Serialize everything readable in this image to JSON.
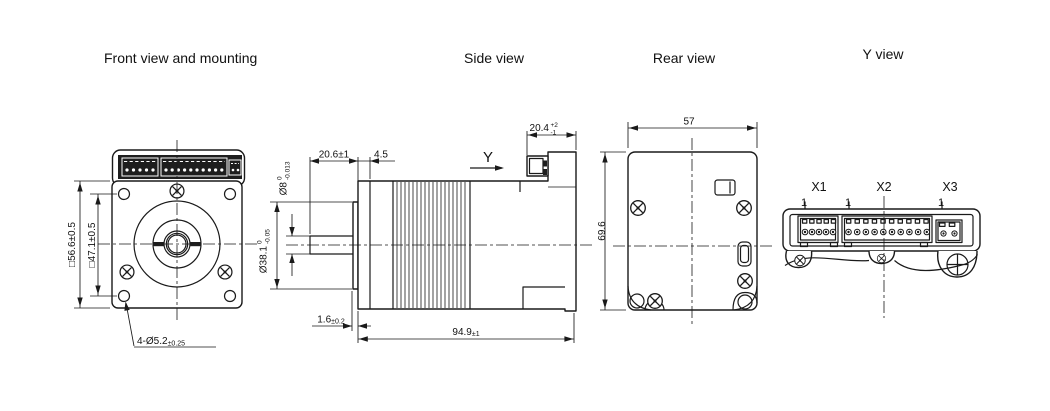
{
  "colors": {
    "line": "#1a1a1a",
    "background": "#ffffff",
    "connector_panel": "#1e1e1e"
  },
  "views": {
    "front": {
      "title": "Front view and mounting",
      "dims": {
        "outer_square": "□56.6±0.5",
        "bolt_square": "□47.1±0.5",
        "mount_holes": "4-Ø5.2",
        "mount_holes_tol": "±0.25"
      }
    },
    "side": {
      "title": "Side view",
      "view_label": "Y",
      "dims": {
        "shaft_length": "20.6±1",
        "front_plate": "4.5",
        "shaft_dia": "Ø8",
        "shaft_dia_upper": "0",
        "shaft_dia_lower": "-0.013",
        "pilot_dia": "Ø38.1",
        "pilot_dia_upper": "0",
        "pilot_dia_lower": "-0.05",
        "pilot_height": "1.6",
        "pilot_height_tol": "±0.2",
        "body_length": "94.9",
        "body_length_tol": "±1",
        "rear_housing": "20.4",
        "rear_housing_upper": "+2",
        "rear_housing_lower": "-1"
      }
    },
    "rear": {
      "title": "Rear view",
      "dims": {
        "width": "57",
        "height": "69.6"
      }
    },
    "yview": {
      "title": "Y view",
      "connectors": [
        {
          "label": "X1",
          "pin1": "1"
        },
        {
          "label": "X2",
          "pin1": "1"
        },
        {
          "label": "X3",
          "pin1": "1"
        }
      ]
    }
  }
}
